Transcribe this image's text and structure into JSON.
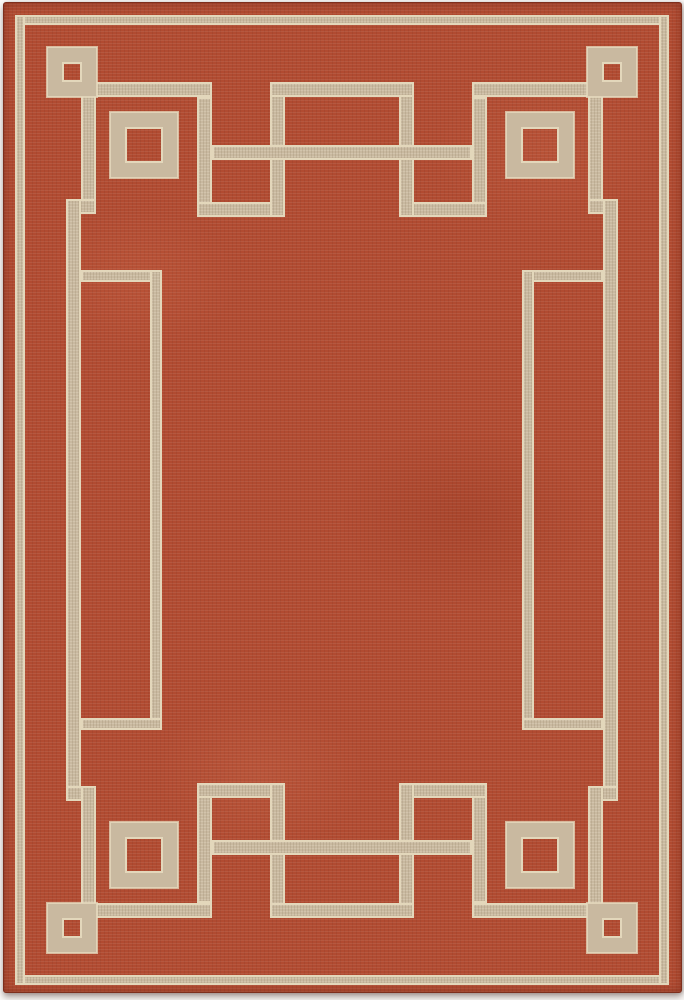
{
  "image": {
    "type": "product-photo",
    "subject": "rectangular area rug",
    "pattern_style": "art-deco greek-key border with corner squares",
    "orientation": "portrait"
  },
  "colors": {
    "field_red": "#b14b31",
    "field_red_dark": "#9c3e28",
    "field_red_light": "#c56a4d",
    "band_beige": "#c9b9a0",
    "band_edge_cream": "#e3d7bb",
    "rug_edge": "#7e2f1d",
    "page_background": "#fbfaf8"
  },
  "rug": {
    "x": 3,
    "y": 2,
    "width": 677,
    "height": 989,
    "bands": [
      {
        "name": "outer-pinstripe-top",
        "x": 15,
        "y": 15,
        "w": 654,
        "h": 10
      },
      {
        "name": "outer-pinstripe-bottom",
        "x": 15,
        "y": 975,
        "w": 654,
        "h": 10
      },
      {
        "name": "outer-pinstripe-left",
        "x": 15,
        "y": 15,
        "w": 10,
        "h": 970
      },
      {
        "name": "outer-pinstripe-right",
        "x": 659,
        "y": 15,
        "w": 10,
        "h": 970
      },
      {
        "name": "top-keyline-left",
        "x": 92,
        "y": 82,
        "w": 120,
        "h": 15
      },
      {
        "name": "top-keyline-right",
        "x": 472,
        "y": 82,
        "w": 120,
        "h": 15
      },
      {
        "name": "top-key-drop-left",
        "x": 197,
        "y": 97,
        "w": 15,
        "h": 120
      },
      {
        "name": "top-key-drop-right",
        "x": 472,
        "y": 97,
        "w": 15,
        "h": 120
      },
      {
        "name": "top-key-return-left",
        "x": 197,
        "y": 202,
        "w": 88,
        "h": 15
      },
      {
        "name": "top-key-return-right",
        "x": 399,
        "y": 202,
        "w": 88,
        "h": 15
      },
      {
        "name": "top-bump-riser-left",
        "x": 270,
        "y": 82,
        "w": 15,
        "h": 135
      },
      {
        "name": "top-bump-riser-right",
        "x": 399,
        "y": 82,
        "w": 15,
        "h": 135
      },
      {
        "name": "top-bump-cap",
        "x": 270,
        "y": 82,
        "w": 144,
        "h": 15
      },
      {
        "name": "top-crossbar",
        "x": 212,
        "y": 145,
        "w": 260,
        "h": 15
      },
      {
        "name": "bottom-keyline-left",
        "x": 92,
        "y": 903,
        "w": 120,
        "h": 15
      },
      {
        "name": "bottom-keyline-right",
        "x": 472,
        "y": 903,
        "w": 120,
        "h": 15
      },
      {
        "name": "bottom-key-drop-left",
        "x": 197,
        "y": 783,
        "w": 15,
        "h": 120
      },
      {
        "name": "bottom-key-drop-right",
        "x": 472,
        "y": 783,
        "w": 15,
        "h": 120
      },
      {
        "name": "bottom-key-return-left",
        "x": 197,
        "y": 783,
        "w": 88,
        "h": 15
      },
      {
        "name": "bottom-key-return-right",
        "x": 399,
        "y": 783,
        "w": 88,
        "h": 15
      },
      {
        "name": "bottom-bump-riser-left",
        "x": 270,
        "y": 783,
        "w": 15,
        "h": 135
      },
      {
        "name": "bottom-bump-riser-right",
        "x": 399,
        "y": 783,
        "w": 15,
        "h": 135
      },
      {
        "name": "bottom-bump-cap",
        "x": 270,
        "y": 903,
        "w": 144,
        "h": 15
      },
      {
        "name": "bottom-crossbar",
        "x": 212,
        "y": 840,
        "w": 260,
        "h": 15
      },
      {
        "name": "left-rail-upper-drop",
        "x": 81,
        "y": 95,
        "w": 15,
        "h": 119
      },
      {
        "name": "left-rail-upper-step",
        "x": 66,
        "y": 199,
        "w": 30,
        "h": 15
      },
      {
        "name": "left-rail",
        "x": 66,
        "y": 199,
        "w": 15,
        "h": 602
      },
      {
        "name": "left-rail-lower-step",
        "x": 66,
        "y": 786,
        "w": 30,
        "h": 15
      },
      {
        "name": "left-rail-lower-drop",
        "x": 81,
        "y": 786,
        "w": 15,
        "h": 119
      },
      {
        "name": "right-rail-upper-drop",
        "x": 588,
        "y": 95,
        "w": 15,
        "h": 119
      },
      {
        "name": "right-rail-upper-step",
        "x": 588,
        "y": 199,
        "w": 30,
        "h": 15
      },
      {
        "name": "right-rail",
        "x": 603,
        "y": 199,
        "w": 15,
        "h": 602
      },
      {
        "name": "right-rail-lower-step",
        "x": 588,
        "y": 786,
        "w": 30,
        "h": 15
      },
      {
        "name": "right-rail-lower-drop",
        "x": 588,
        "y": 786,
        "w": 15,
        "h": 119
      },
      {
        "name": "inner-bracket-left-top",
        "x": 81,
        "y": 270,
        "w": 81,
        "h": 12
      },
      {
        "name": "inner-bracket-left-vertical",
        "x": 150,
        "y": 270,
        "w": 12,
        "h": 460
      },
      {
        "name": "inner-bracket-left-bottom",
        "x": 81,
        "y": 718,
        "w": 81,
        "h": 12
      },
      {
        "name": "inner-bracket-right-top",
        "x": 522,
        "y": 270,
        "w": 81,
        "h": 12
      },
      {
        "name": "inner-bracket-right-vertical",
        "x": 522,
        "y": 270,
        "w": 12,
        "h": 460
      },
      {
        "name": "inner-bracket-right-bottom",
        "x": 522,
        "y": 718,
        "w": 81,
        "h": 12
      }
    ],
    "squares": [
      {
        "name": "small-corner-square-top-left",
        "x": 47,
        "y": 47,
        "w": 50,
        "h": 50,
        "line": 15
      },
      {
        "name": "small-corner-square-top-right",
        "x": 587,
        "y": 47,
        "w": 50,
        "h": 50,
        "line": 15
      },
      {
        "name": "small-corner-square-bottom-left",
        "x": 47,
        "y": 903,
        "w": 50,
        "h": 50,
        "line": 15
      },
      {
        "name": "small-corner-square-bottom-right",
        "x": 587,
        "y": 903,
        "w": 50,
        "h": 50,
        "line": 15
      },
      {
        "name": "big-corner-square-top-left",
        "x": 110,
        "y": 112,
        "w": 68,
        "h": 66,
        "line": 15
      },
      {
        "name": "big-corner-square-top-right",
        "x": 506,
        "y": 112,
        "w": 68,
        "h": 66,
        "line": 15
      },
      {
        "name": "big-corner-square-bottom-left",
        "x": 110,
        "y": 822,
        "w": 68,
        "h": 66,
        "line": 15
      },
      {
        "name": "big-corner-square-bottom-right",
        "x": 506,
        "y": 822,
        "w": 68,
        "h": 66,
        "line": 15
      }
    ]
  }
}
